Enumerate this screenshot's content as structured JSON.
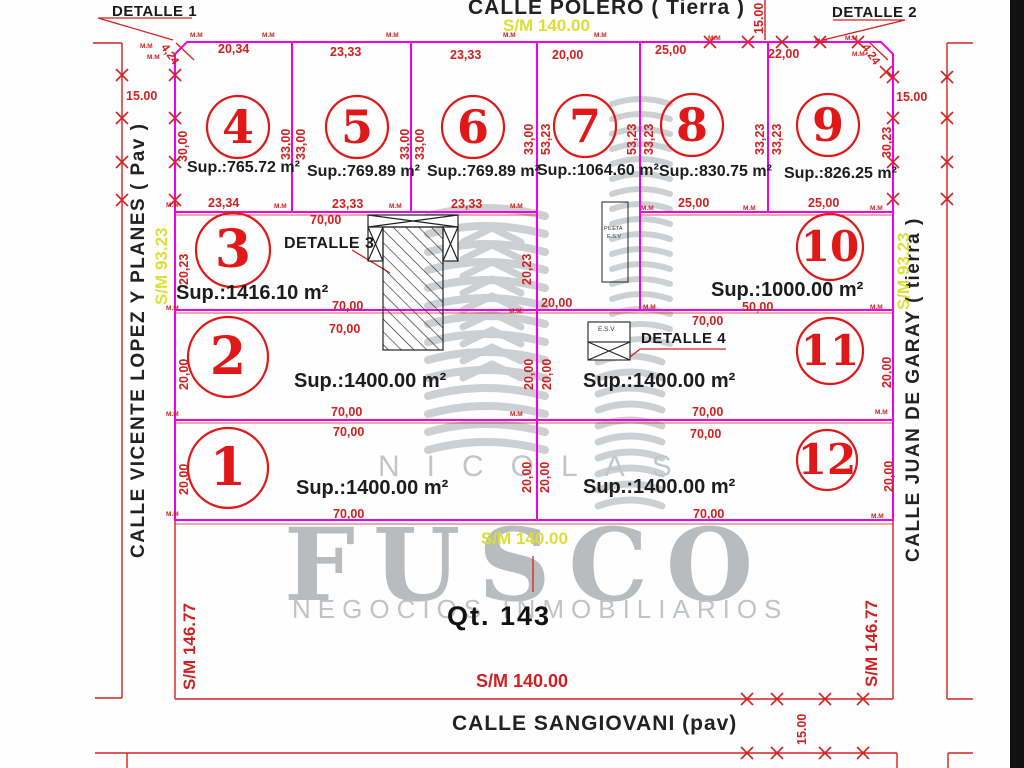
{
  "streets": {
    "top": "CALLE POLERO ( Tierra )",
    "bottom": "CALLE SANGIOVANI (pav)",
    "left": "CALLE VICENTE LOPEZ Y PLANES ( Pav )",
    "right": "CALLE JUAN DE GARAY ( tierra )"
  },
  "labels": {
    "mm": "M.M",
    "block": "Qt. 143",
    "detalle1": "DETALLE 1",
    "detalle2": "DETALLE 2",
    "detalle3": "DETALLE 3",
    "detalle4": "DETALLE 4",
    "chamfer": "4,24",
    "esv": "E.S.V",
    "pileta": "PILETA",
    "sm_top": "S/M 140.00",
    "sm_bottom_inner": "S/M 140.00",
    "sm_bottom_outer": "S/M 140.00",
    "sm_left": "S/M 93.23",
    "sm_right": "S/M 93.23",
    "sm_left_low": "S/M 146.77",
    "sm_right_low": "S/M 146.77"
  },
  "watermark": {
    "name": "NICOLAS",
    "brand": "FUSCO",
    "tagline": "NEGOCIOS INMOBILIARIOS"
  },
  "lots": [
    {
      "num": "1",
      "sup": "Sup.:1400.00 m²"
    },
    {
      "num": "2",
      "sup": "Sup.:1400.00 m²"
    },
    {
      "num": "3",
      "sup": "Sup.:1416.10 m²"
    },
    {
      "num": "4",
      "sup": "Sup.:765.72 m²"
    },
    {
      "num": "5",
      "sup": "Sup.:769.89 m²"
    },
    {
      "num": "6",
      "sup": "Sup.:769.89 m²"
    },
    {
      "num": "7",
      "sup": "Sup.:1064.60 m²"
    },
    {
      "num": "8",
      "sup": "Sup.:830.75 m²"
    },
    {
      "num": "9",
      "sup": "Sup.:826.25 m²"
    },
    {
      "num": "10",
      "sup": "Sup.:1000.00 m²"
    },
    {
      "num": "11",
      "sup": "Sup.:1400.00 m²"
    },
    {
      "num": "12",
      "sup": "Sup.:1400.00 m²"
    }
  ],
  "dims_h": [
    "20,34",
    "23,33",
    "23,33",
    "20,00",
    "25,00",
    "22,00",
    "23,34",
    "23,33",
    "23,33",
    "25,00",
    "25,00",
    "70,00",
    "70,00",
    "20,00",
    "50,00",
    "70,00",
    "70,00",
    "70,00",
    "70,00",
    "70,00",
    "70,00",
    "70,00",
    "70,00",
    "15.00",
    "15.00"
  ],
  "dims_v": [
    "30,00",
    "33,00",
    "33,00",
    "33,00",
    "33,00",
    "33,00",
    "53,23",
    "53,23",
    "33,23",
    "33,23",
    "33,23",
    "30,23",
    "20,23",
    "20,23",
    "20,00",
    "20,00",
    "20,00",
    "20,00",
    "20,00",
    "20,00",
    "20,00",
    "20,00",
    "15.00",
    "15.00"
  ],
  "colors": {
    "parcel_line": "#ee00ee",
    "dimension": "#d02020",
    "highlight": "#dedf33",
    "watermark": "#c3c7ca"
  }
}
